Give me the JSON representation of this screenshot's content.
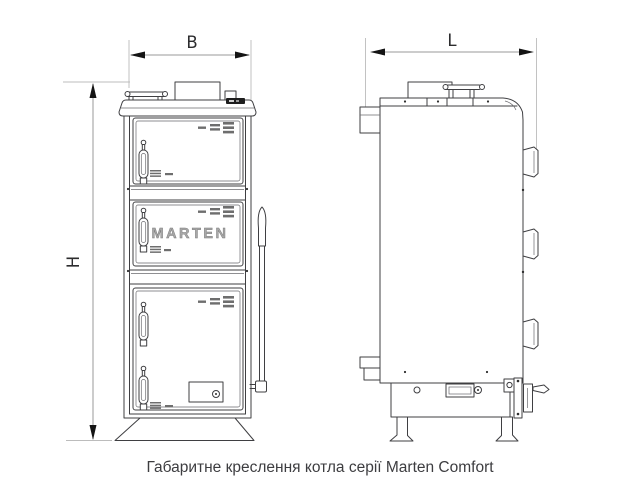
{
  "caption": "Габаритне креслення котла серії Marten Comfort",
  "dimension_labels": {
    "width": "B",
    "length": "L",
    "height": "H"
  },
  "front_view": {
    "brand_plate": "MARTEN"
  },
  "colors": {
    "background": "#ffffff",
    "outline": "#3f3f42",
    "dimension_line": "#9a9a9a",
    "extension_line": "#bcbcbc",
    "arrowhead": "#141414",
    "label_text": "#2c2c2e",
    "brand_text": "#a8a8a8",
    "caption_text": "#3d3d40",
    "thermometer_display": "#1e1e1e",
    "vent_slots": "#6e6e6e"
  }
}
